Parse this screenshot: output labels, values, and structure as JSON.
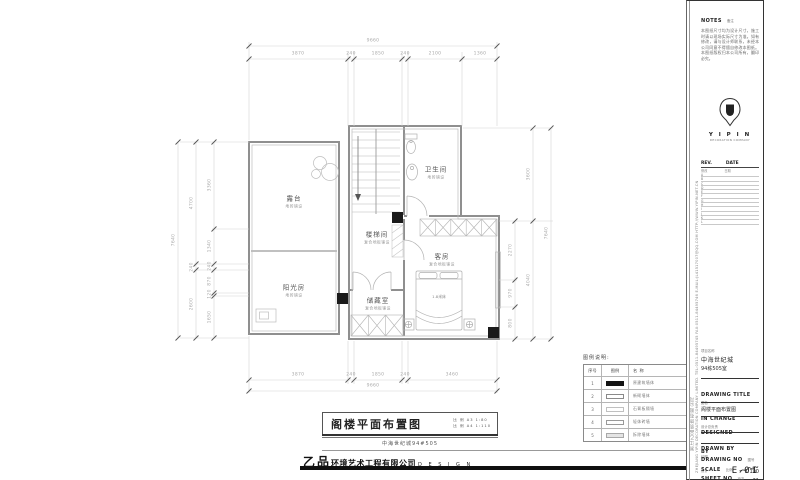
{
  "plan": {
    "rooms": [
      {
        "name": "露台",
        "finish": "地砖铺设"
      },
      {
        "name": "阳光房",
        "finish": "地砖铺设"
      },
      {
        "name": "楼梯间",
        "finish": "复合地板铺设"
      },
      {
        "name": "卫生间",
        "finish": "地砖铺设"
      },
      {
        "name": "客房",
        "finish": "复合地板铺设"
      },
      {
        "name": "储藏室",
        "finish": "复合地板铺设"
      }
    ],
    "bed_label": "1.8米床"
  },
  "dims": {
    "top_overall": "9660",
    "top": [
      "3870",
      "240",
      "1850",
      "240",
      "2100",
      "1360"
    ],
    "bottom": [
      "3870",
      "240",
      "1850",
      "240",
      "3460"
    ],
    "bottom_overall": "9660",
    "left_outer": "7640",
    "left_mid": [
      "4700",
      "240",
      "2600"
    ],
    "left_inner": [
      "3360",
      "1340",
      "240",
      "870",
      "120",
      "1650"
    ],
    "right_inner": [
      "2270",
      "970",
      "800"
    ],
    "right_mid": [
      "3600",
      "4040"
    ],
    "right_outer": "7640"
  },
  "legend": {
    "title": "图例说明:",
    "headers": [
      "序号",
      "图例",
      "名 称"
    ],
    "rows": [
      {
        "no": "1",
        "name": "原建筑墙体"
      },
      {
        "no": "2",
        "name": "新砌墙体"
      },
      {
        "no": "3",
        "name": "石膏板隔墙"
      },
      {
        "no": "4",
        "name": "轻体砖墙"
      },
      {
        "no": "5",
        "name": "拆除墙体"
      }
    ]
  },
  "titlebar": {
    "title": "阁楼平面布置图",
    "scale_a3": "比 例 A3 1:80",
    "scale_a4": "比 例 A4 1:110",
    "subtitle": "中海世纪城94#505"
  },
  "footer": {
    "logo_cn": "乙品",
    "logo_rest": "环境艺术工程有限公司",
    "logo_en": "D E S I G N"
  },
  "titleblock": {
    "notes_en": "NOTES",
    "notes_cn": "备注",
    "notes_body": "本图纸尺寸均为设计尺寸，施工时请以现场实际尺寸为准。如有修改，请与设计师联系，未经本公司同意不得擅自修改本图纸。本图纸版权归本公司所有，翻印必究。",
    "logo_text": "Y I P I N",
    "logo_sub": "DECORATION COMPANY",
    "rev_label": "REV.",
    "date_label": "DATE",
    "rev_cn": "修改",
    "date_cn": "日期",
    "rev_rows": [
      "A",
      "B",
      "C",
      "D",
      "E",
      "F",
      "G",
      "H",
      "I",
      "J",
      "K",
      "L"
    ],
    "project_label": "项目名称",
    "project_name": "中海世纪城",
    "project_room": "94栋505室",
    "drawing_title_label": "DRAWING TITLE",
    "drawing_title_cn": "图名",
    "drawing_title": "阁楼平面布置图",
    "in_change_label": "IN CHANGE",
    "in_change_cn": "设计总负责",
    "designed_by_label": "DESIGNED BY",
    "designed_by_cn": "设计",
    "drawn_by_label": "DRAWN BY",
    "drawn_by_cn": "绘图",
    "drawing_no_label": "DRAWING NO",
    "drawing_no_cn": "图号",
    "drawing_no": "E-01",
    "scale_label": "SCALE",
    "scale_cn": "比例",
    "scale": "1:100",
    "sheet_label": "SHEET NO",
    "sheet_cn": "页次",
    "sheet_no": "21",
    "side_text_cn": "浙江乙品装饰有限公司",
    "side_text_en": "ZHEJIANG YIPIN DECORATION COMPANY LIMITED.  TEL:0511-84495745  FAX:0511-84495746  E-MAIL:JL41517007@QQ.COM  HTTP://WWW.YIPIN.NET.CN"
  }
}
